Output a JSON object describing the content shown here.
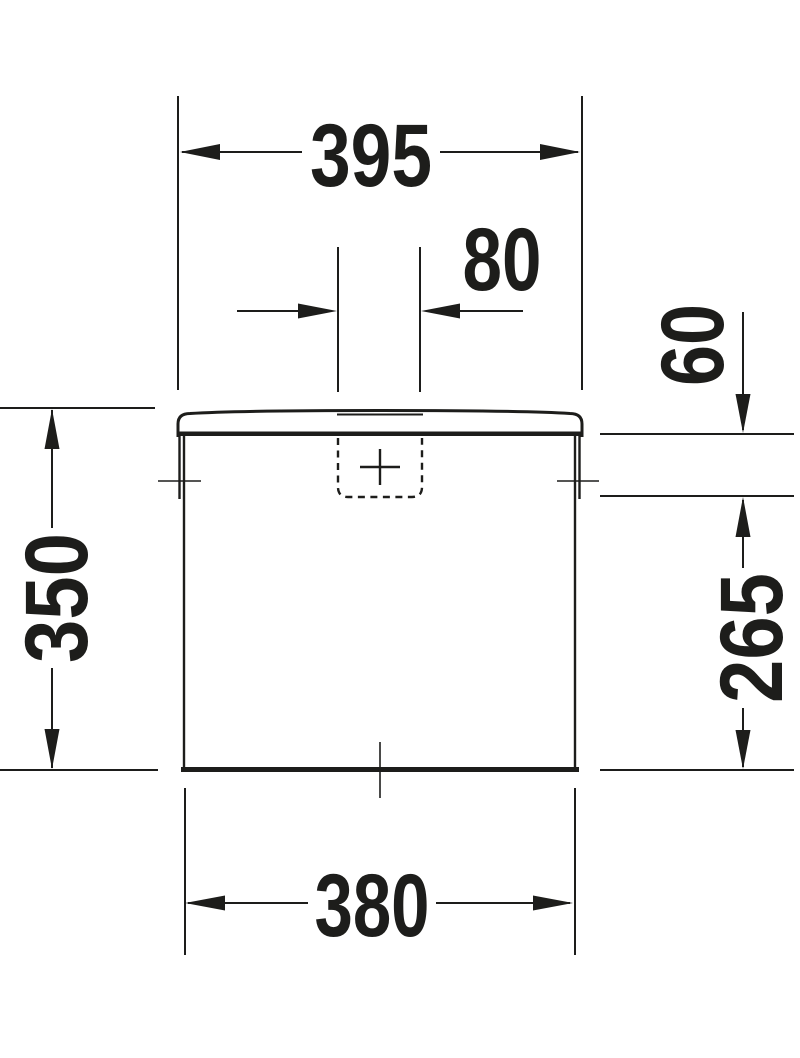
{
  "dimensions": {
    "lid_width": "395",
    "button_width": "80",
    "inlet_top_offset": "60",
    "tank_height": "350",
    "inlet_height": "265",
    "body_width": "380"
  },
  "colors": {
    "line": "#1d1d1b",
    "background": "#ffffff"
  }
}
